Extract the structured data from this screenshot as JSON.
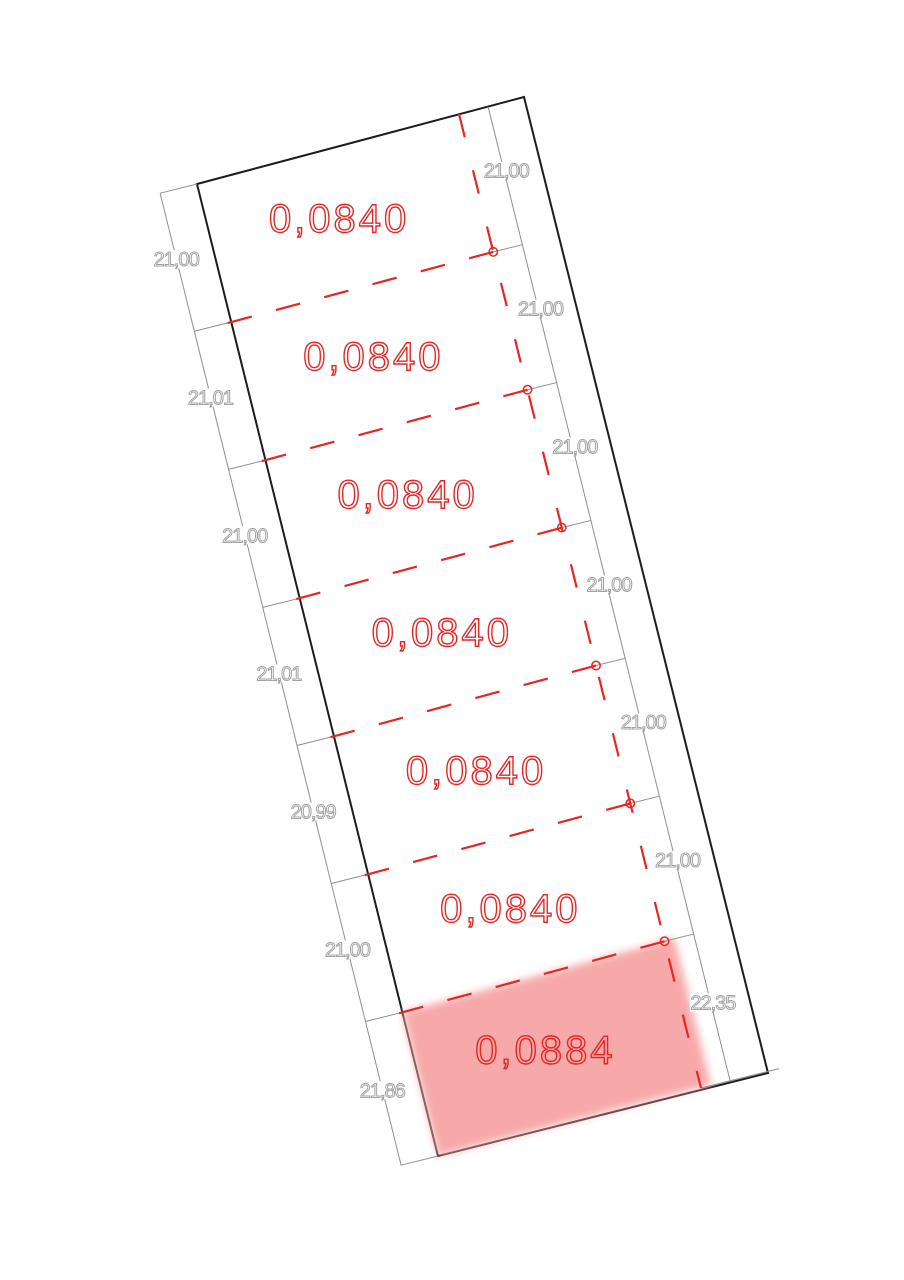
{
  "drawing": {
    "type": "cadastral-parcel-plan",
    "parcels": [
      {
        "area": "0,0840",
        "highlighted": false
      },
      {
        "area": "0,0840",
        "highlighted": false
      },
      {
        "area": "0,0840",
        "highlighted": false
      },
      {
        "area": "0,0840",
        "highlighted": false
      },
      {
        "area": "0,0840",
        "highlighted": false
      },
      {
        "area": "0,0840",
        "highlighted": false
      },
      {
        "area": "0,0884",
        "highlighted": true
      }
    ],
    "left_dimensions": [
      "21,00",
      "21,01",
      "21,00",
      "21,01",
      "20,99",
      "21,00",
      "21,86"
    ],
    "right_dimensions": [
      "21,00",
      "21,00",
      "21,00",
      "21,00",
      "21,00",
      "21,00",
      "22,35"
    ],
    "colors": {
      "outline": "#1c1c1c",
      "red": "#e32726",
      "highlight_fill": "#f7a9a9",
      "dimension_line": "#8f8f8f",
      "dimension_text": "#a3a3a3",
      "background": "#ffffff"
    }
  }
}
